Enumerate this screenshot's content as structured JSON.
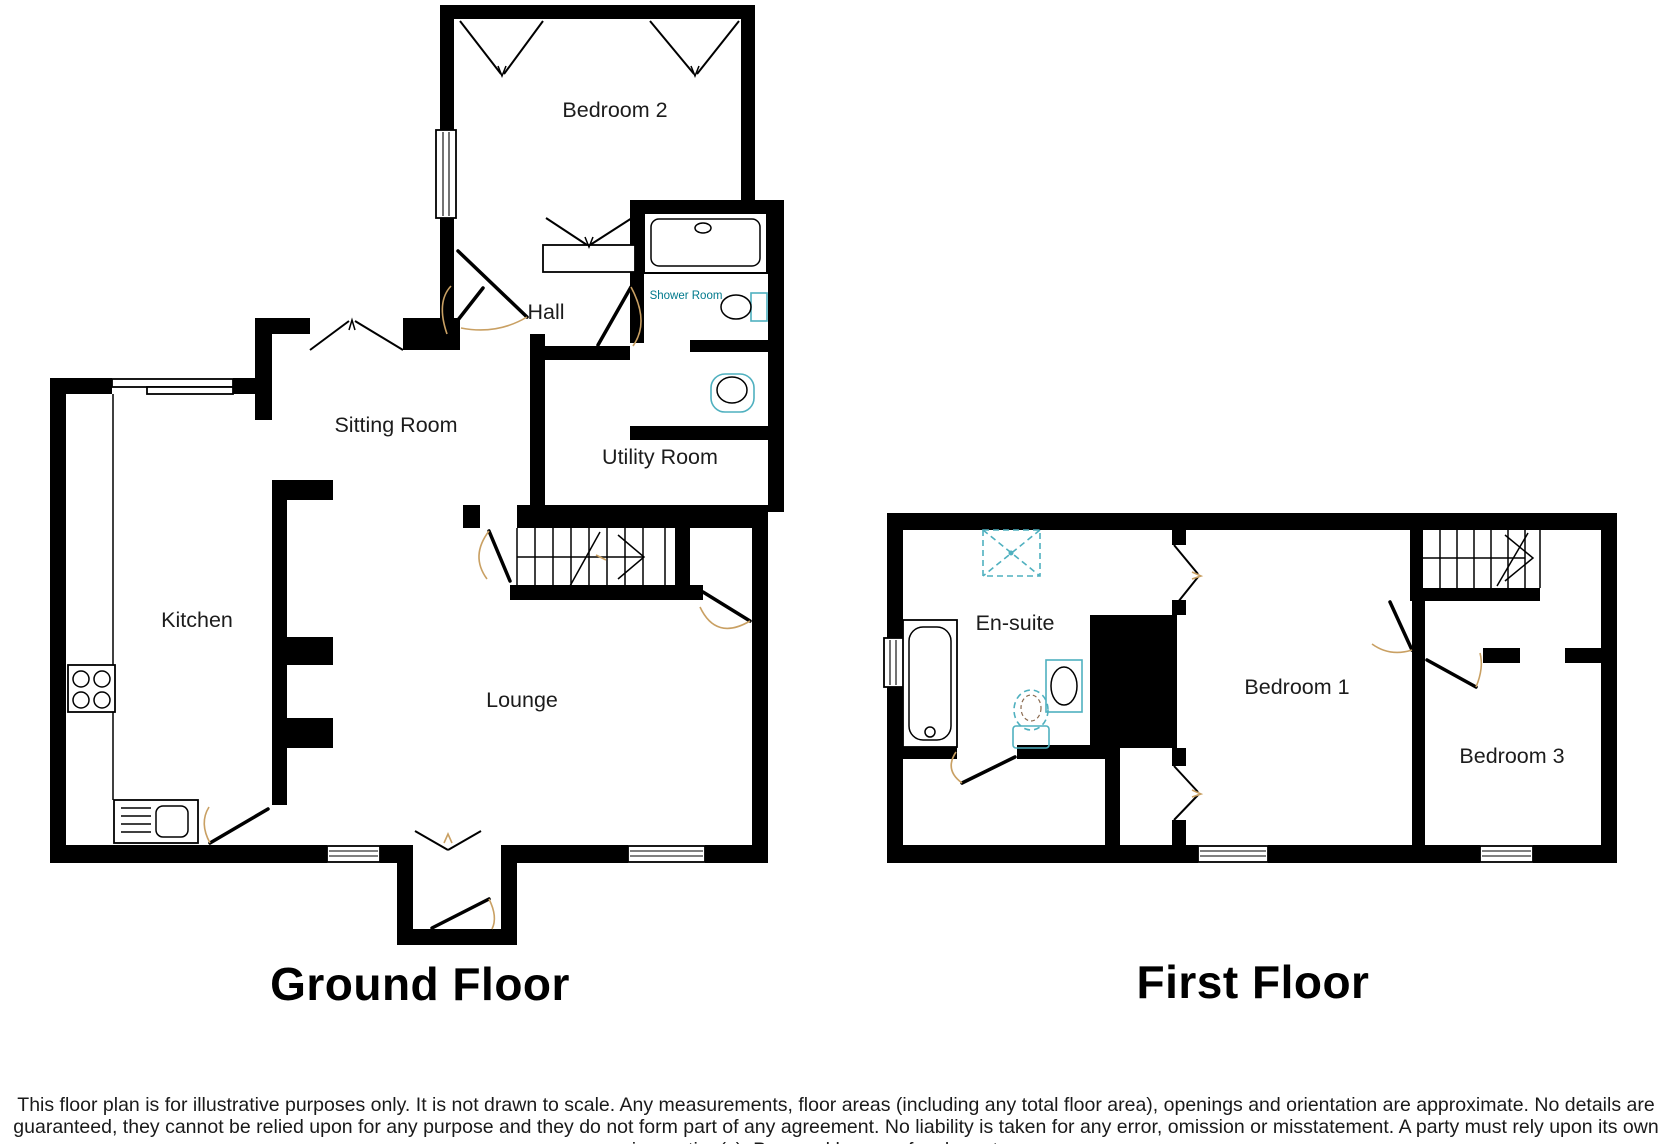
{
  "titles": {
    "ground_floor": "Ground Floor",
    "first_floor": "First Floor"
  },
  "rooms": {
    "ground_floor": {
      "bedroom2": "Bedroom 2",
      "hall": "Hall",
      "shower_room": "Shower Room",
      "sitting_room": "Sitting Room",
      "utility_room": "Utility Room",
      "kitchen": "Kitchen",
      "lounge": "Lounge"
    },
    "first_floor": {
      "ensuite": "En-suite",
      "bedroom1": "Bedroom 1",
      "bedroom3": "Bedroom 3"
    }
  },
  "disclaimer": "This floor plan is for illustrative purposes only. It is not drawn to scale. Any measurements, floor areas (including any total floor area), openings and orientation are approximate. No details are guaranteed, they cannot be relied upon for any purpose and they do not form part of any agreement. No liability is taken for any error, omission or misstatement. A party must rely upon its own inspection(s). Powered by www.focalagent.com",
  "colors": {
    "wall": "#000000",
    "label": "#1c1c1c",
    "fixture": "#4fb0bf",
    "fixture_label": "#00798c",
    "swing": "#c9a063"
  }
}
